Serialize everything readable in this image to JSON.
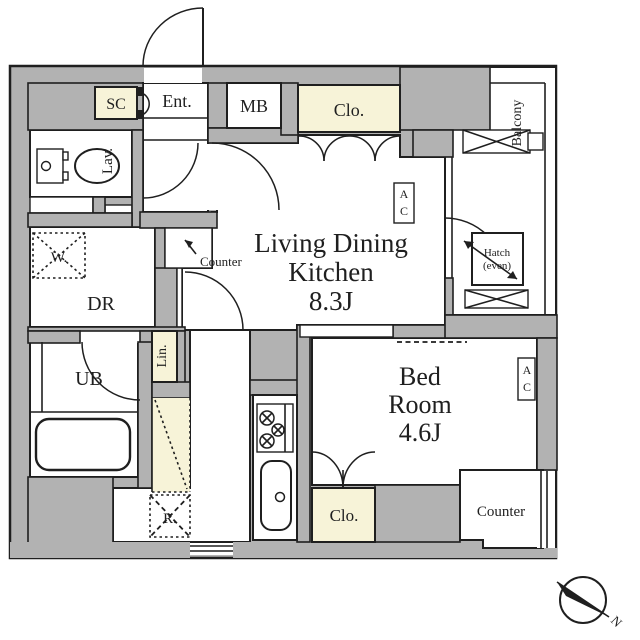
{
  "colors": {
    "wall": "#b2b2b2",
    "floor": "#ffffff",
    "accent": "#f7f3d8",
    "line": "#1f1f1f",
    "bg": "#ffffff"
  },
  "unit": {
    "entrance": {
      "shoe_closet": "SC",
      "entry": "Ent.",
      "meter_box": "MB"
    },
    "ldk": {
      "title": [
        "Living Dining",
        "Kitchen",
        "8.3J"
      ],
      "closet": "Clo.",
      "counter": "Counter",
      "ac_top": "A",
      "ac_bottom": "C"
    },
    "washroom": {
      "lavatory": "Lav.",
      "washer": "W.",
      "dressing_room": "DR",
      "unit_bath": "UB",
      "linen": "Lin.",
      "fridge": "R."
    },
    "bedroom": {
      "title": [
        "Bed",
        "Room",
        "4.6J"
      ],
      "closet": "Clo.",
      "counter": "Counter",
      "ac_top": "A",
      "ac_bottom": "C"
    },
    "balcony": {
      "label": "Balcony",
      "hatch": "Hatch",
      "hatch_note": "(even)"
    },
    "compass": {
      "north": "N"
    }
  }
}
